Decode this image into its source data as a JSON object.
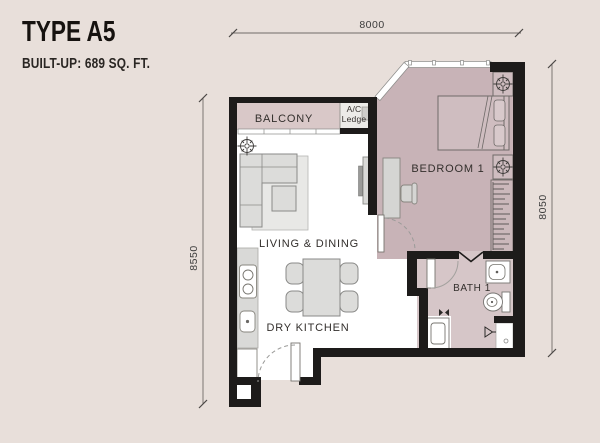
{
  "title": "TYPE A5",
  "subtitle": "BUILT-UP: 689 SQ. FT.",
  "plan": {
    "rooms": {
      "balcony": "BALCONY",
      "ac_ledge_line1": "A/C",
      "ac_ledge_line2": "Ledge",
      "bedroom": "BEDROOM 1",
      "living_dining": "LIVING & DINING",
      "dry_kitchen": "DRY KITCHEN",
      "bath": "BATH 1"
    },
    "dimensions": {
      "top": "8000",
      "right": "8050",
      "left": "8550"
    }
  },
  "colors": {
    "background": "#e8dfda",
    "wall": "#1d1b1a",
    "bedroom_floor": "#c8b3b7",
    "balcony_floor": "#d9c8c8",
    "bath_floor": "#d6c6c8",
    "interior_floor": "#ffffff",
    "furniture": "#dcdcda"
  }
}
